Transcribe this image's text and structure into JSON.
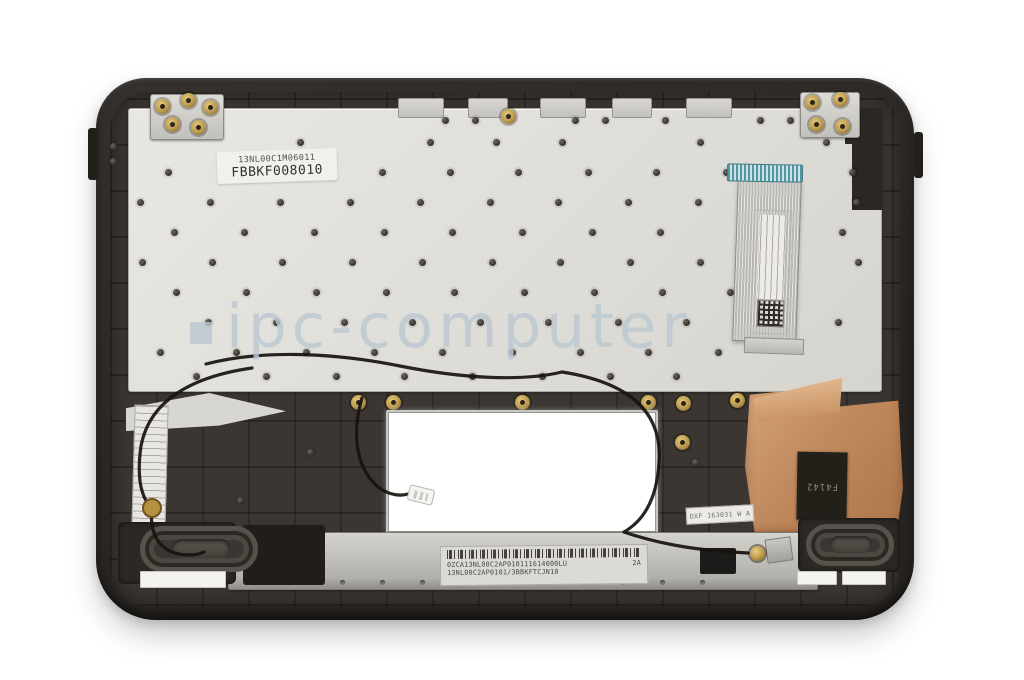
{
  "watermark": {
    "text": "ipc-computer"
  },
  "stickers": {
    "keyboard_plate": {
      "line1": "13NL00C1M06011",
      "line2": "FBBKF008010"
    },
    "copper_tag": {
      "text": "F4142"
    },
    "support_bracket": {
      "barcode_line": "0ZCA13NL00C2AP010111614000LU",
      "suffix": "2A",
      "line2": "13NL00C2AP0101/3BBKFTCJN10"
    },
    "corner_tag": {
      "text": "DXF 163031 W A"
    }
  },
  "colors": {
    "background": "#ffffff",
    "frame": "#2e2a27",
    "plate": "#e0ded9",
    "lower": "#3b3631",
    "copper": "#c08a5f",
    "teal": "#4f98a2",
    "watermark": "#bcc8d2",
    "silver": "#c7c5c0",
    "brass": "#b9994f"
  }
}
